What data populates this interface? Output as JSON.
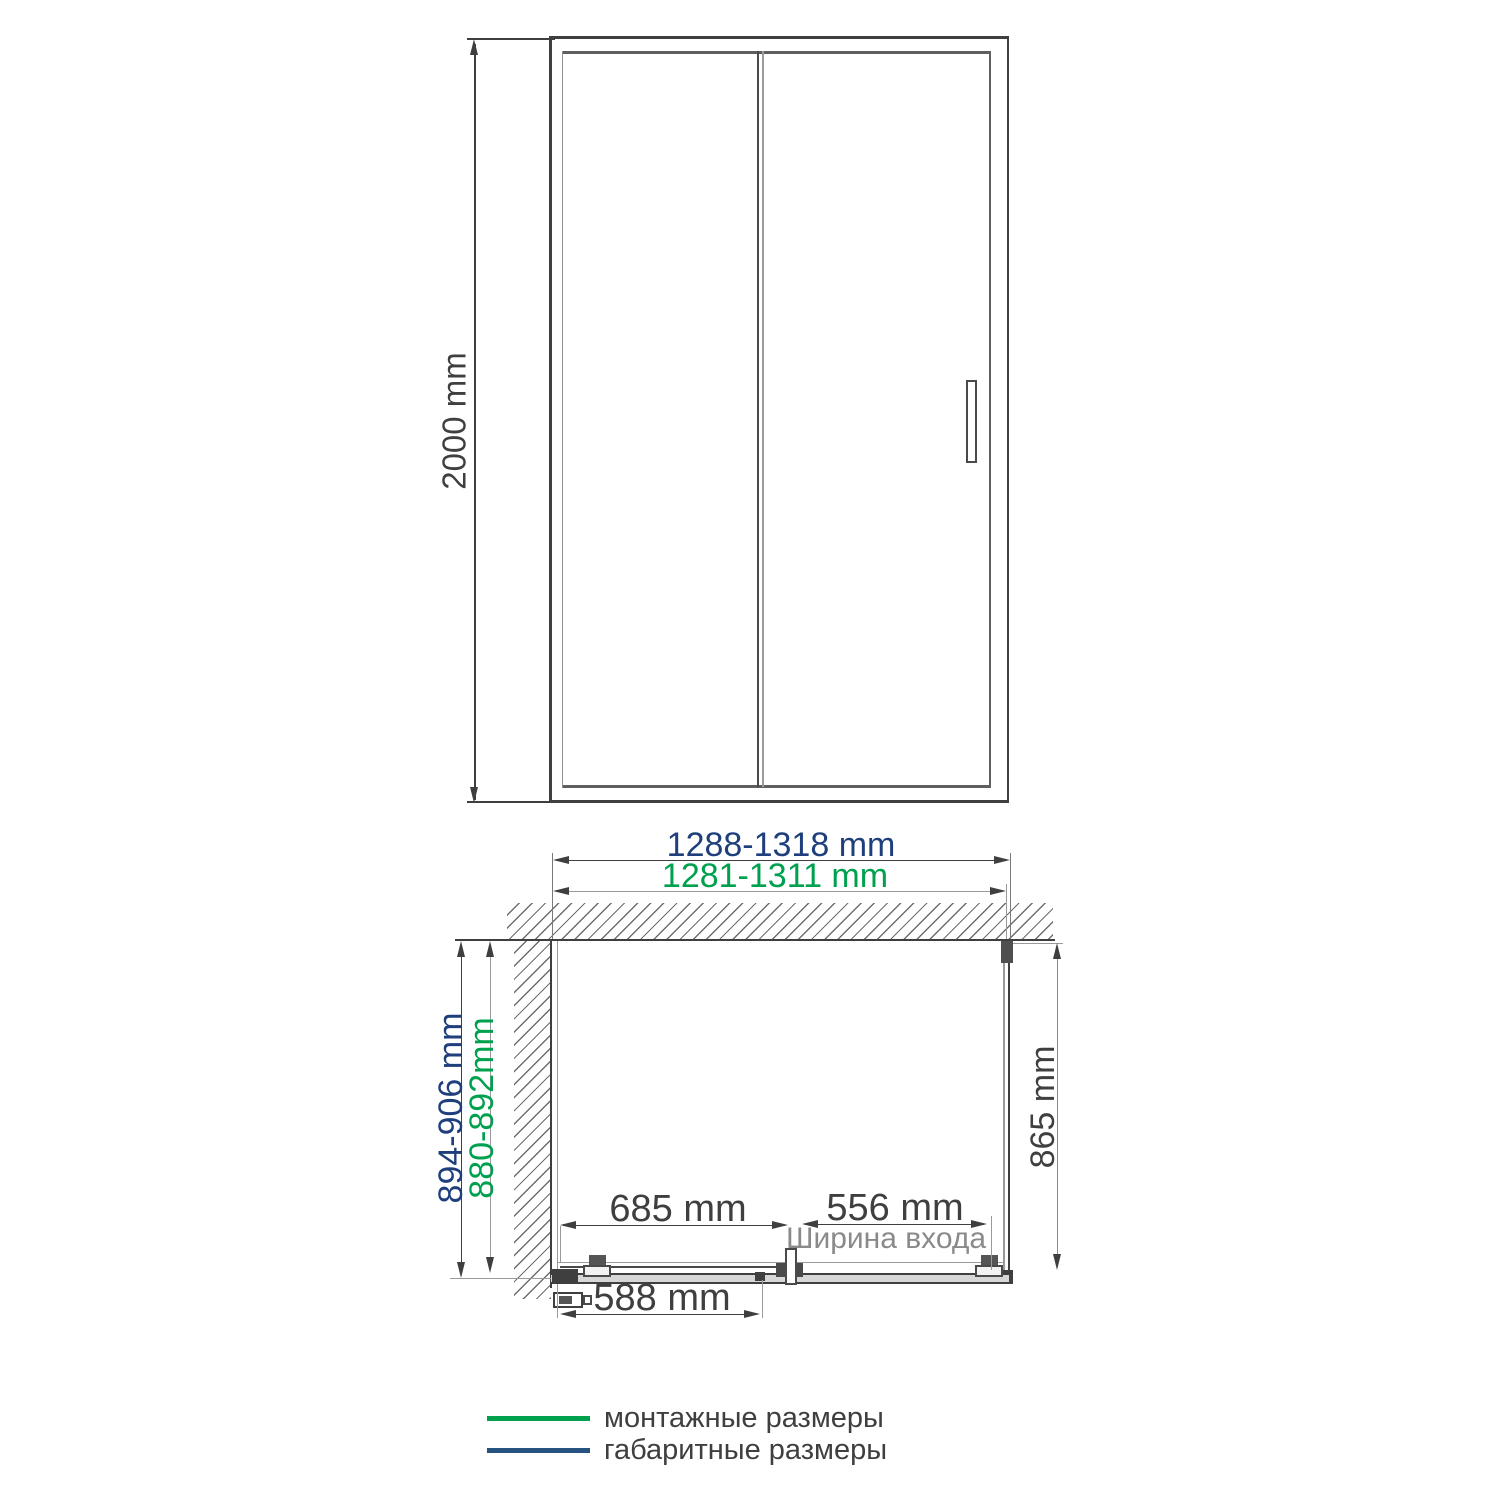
{
  "front_view": {
    "height_dimension": "2000 mm"
  },
  "plan_view": {
    "overall_width": "1288-1318 mm",
    "mounting_width": "1281-1311 mm",
    "overall_depth": "894-906 mm",
    "mounting_depth": "880-892mm",
    "side_panel_depth": "865 mm",
    "fixed_segment_width": "685 mm",
    "entrance_width": "556 mm",
    "entrance_caption": "Ширина входа",
    "door_width": "588 mm"
  },
  "legend": {
    "items": [
      {
        "label": "монтажные размеры",
        "color": "#00A14E"
      },
      {
        "label": "габаритные размеры",
        "color": "#26527F"
      }
    ]
  },
  "colors": {
    "dimension_blue": "#1E3F7C",
    "dimension_green": "#00A14E",
    "line_dark": "#3F3F3F",
    "line_gray": "#909090",
    "caption_gray": "#8A8A8A"
  }
}
